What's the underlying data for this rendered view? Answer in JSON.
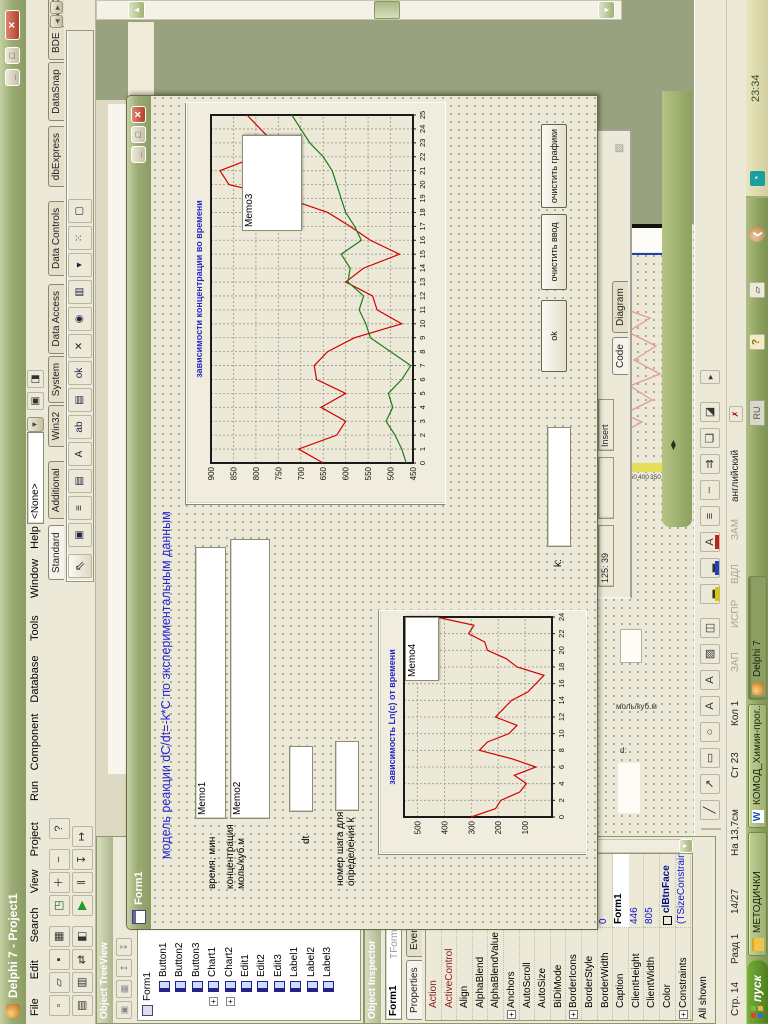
{
  "ide": {
    "title": "Delphi 7 - Project1",
    "menu": [
      "File",
      "Edit",
      "Search",
      "View",
      "Project",
      "Run",
      "Component",
      "Database",
      "Tools",
      "Window",
      "Help"
    ],
    "desktop_combo": "<None>",
    "toolbar_row1": [
      {
        "n": "new-icon",
        "g": "▫"
      },
      {
        "n": "open-icon",
        "g": "▱"
      },
      {
        "n": "save-icon",
        "g": "▪"
      },
      {
        "n": "save-all-icon",
        "g": "▦"
      },
      {
        "n": "open-project-icon",
        "g": "◳"
      },
      {
        "n": "add-file-icon",
        "g": "＋"
      },
      {
        "n": "remove-file-icon",
        "g": "−"
      },
      {
        "n": "help-icon",
        "g": "?"
      }
    ],
    "toolbar_row2": [
      {
        "n": "view-unit-icon",
        "g": "▤"
      },
      {
        "n": "view-form-icon",
        "g": "▥"
      },
      {
        "n": "toggle-form-icon",
        "g": "⇄"
      },
      {
        "n": "new-form-icon",
        "g": "◧"
      },
      {
        "n": "run-icon",
        "g": "▶"
      },
      {
        "n": "pause-icon",
        "g": "‖"
      },
      {
        "n": "trace-into-icon",
        "g": "↧"
      },
      {
        "n": "step-over-icon",
        "g": "↦"
      }
    ],
    "palette_tabs": [
      "Standard",
      "Additional",
      "Win32",
      "System",
      "Data Access",
      "Data Controls",
      "dbExpress",
      "DataSnap",
      "BDE",
      "ADO",
      "InterBase",
      "WebServices",
      "InternetExpress"
    ],
    "palette_active": "Standard",
    "palette_icons": [
      {
        "n": "frames-icon",
        "g": "▣"
      },
      {
        "n": "main-menu-icon",
        "g": "≡"
      },
      {
        "n": "popup-menu-icon",
        "g": "▤"
      },
      {
        "n": "label-icon",
        "g": "A"
      },
      {
        "n": "edit-icon",
        "g": "ab"
      },
      {
        "n": "memo-icon",
        "g": "▤"
      },
      {
        "n": "button-icon",
        "g": "ok"
      },
      {
        "n": "checkbox-icon",
        "g": "✕"
      },
      {
        "n": "radiobutton-icon",
        "g": "◉"
      },
      {
        "n": "listbox-icon",
        "g": "▥"
      },
      {
        "n": "combobox-icon",
        "g": "▾"
      },
      {
        "n": "scrollbar-icon",
        "g": "⁙"
      },
      {
        "n": "groupbox-icon",
        "g": "▢"
      }
    ]
  },
  "treeview": {
    "title": "Object TreeView",
    "root": "Form1",
    "items": [
      "Button1",
      "Button2",
      "Button3",
      "Chart1",
      "Chart2",
      "Edit1",
      "Edit2",
      "Edit3",
      "Label1",
      "Label2",
      "Label3"
    ],
    "expandable": [
      "Chart1",
      "Chart2"
    ]
  },
  "inspector": {
    "title": "Object Inspector",
    "object_name": "Form1",
    "object_type": "TForm1",
    "tabs": [
      "Properties",
      "Events"
    ],
    "props": [
      {
        "n": "Action",
        "v": "",
        "red": true
      },
      {
        "n": "ActiveControl",
        "v": "",
        "red": true
      },
      {
        "n": "Align",
        "v": "alNone"
      },
      {
        "n": "AlphaBlend",
        "v": "False"
      },
      {
        "n": "AlphaBlendValue",
        "v": "255"
      },
      {
        "n": "Anchors",
        "v": "[akLeft,akTop]",
        "exp": true
      },
      {
        "n": "AutoScroll",
        "v": "True"
      },
      {
        "n": "AutoSize",
        "v": "False"
      },
      {
        "n": "BiDiMode",
        "v": "bdLeftToRight"
      },
      {
        "n": "BorderIcons",
        "v": "[biSystemMenu,",
        "exp": true
      },
      {
        "n": "BorderStyle",
        "v": "bsSizeable"
      },
      {
        "n": "BorderWidth",
        "v": "0"
      },
      {
        "n": "Caption",
        "v": "Form1",
        "edit": true
      },
      {
        "n": "ClientHeight",
        "v": "446"
      },
      {
        "n": "ClientWidth",
        "v": "805"
      },
      {
        "n": "Color",
        "v": "clBtnFace",
        "swatch": true
      },
      {
        "n": "Constraints",
        "v": "(TSizeConstraints)",
        "exp": true
      }
    ],
    "status": "All shown"
  },
  "form": {
    "title": "Form1",
    "heading": "модель реакции dC/dt=-k*C по экспериментальным данным",
    "label_time": "время, мин",
    "label_conc1": "концентрация",
    "label_conc2": "моль/куб.м",
    "label_dt": "dt",
    "label_step1": "номер шага для",
    "label_step2": "определения k",
    "label_k": "k:",
    "memo1": "Memo1",
    "memo2": "Memo2",
    "memo3": "Memo3",
    "memo4": "Memo4",
    "buttons": [
      "ok",
      "очистить ввод",
      "очистить графики"
    ]
  },
  "chart_data": [
    {
      "type": "line",
      "title": "зависимости концентрации во времени",
      "x_ticks": [
        0,
        1,
        2,
        3,
        4,
        5,
        6,
        7,
        8,
        9,
        10,
        11,
        12,
        13,
        14,
        15,
        16,
        17,
        18,
        19,
        20,
        21,
        22,
        23,
        24,
        25
      ],
      "ylim": [
        450,
        900
      ],
      "y_ticks": [
        450,
        500,
        550,
        600,
        650,
        700,
        750,
        800,
        850,
        900
      ],
      "grid": true,
      "series": [
        {
          "name": "red",
          "color": "#D40000",
          "values": [
            650,
            705,
            620,
            600,
            655,
            600,
            665,
            670,
            640,
            580,
            475,
            530,
            540,
            600,
            560,
            480,
            545,
            590,
            640,
            730,
            860,
            880,
            800,
            760,
            790,
            820
          ]
        },
        {
          "name": "green",
          "color": "#1B7E1B",
          "values": [
            465,
            475,
            490,
            510,
            495,
            505,
            475,
            455,
            500,
            545,
            555,
            570,
            560,
            595,
            590,
            610,
            565,
            580,
            600,
            610,
            620,
            630,
            650,
            680,
            700,
            720
          ]
        }
      ]
    },
    {
      "type": "line",
      "title": "зависимость Ln(c) от времени",
      "x_ticks": [
        0,
        2,
        4,
        6,
        8,
        10,
        12,
        14,
        16,
        18,
        20,
        22,
        24
      ],
      "ylim": [
        0,
        550
      ],
      "y_ticks": [
        100,
        200,
        300,
        400,
        500
      ],
      "grid": true,
      "series": [
        {
          "name": "red",
          "color": "#D40000",
          "values": [
            300,
            210,
            190,
            120,
            95,
            140,
            60,
            150,
            270,
            240,
            160,
            130,
            210,
            180,
            150,
            90,
            60,
            30,
            130,
            170,
            240,
            250,
            310,
            290,
            430
          ]
        }
      ]
    }
  ],
  "editor": {
    "line_col": "125: 39",
    "mode": "Insert",
    "tabs": [
      "Code",
      "Diagram"
    ]
  },
  "word": {
    "status_cells": [
      "Стр. 14",
      "Разд 1",
      "14/27",
      "На 13,7см",
      "Ст 23",
      "Кол 1"
    ],
    "indicators": [
      "ЗАП",
      "ИСПР",
      "ВДЛ",
      "ЗАМ"
    ],
    "language": "английский",
    "fragment_axis": [
      "500",
      "450",
      "400",
      "350",
      "300"
    ],
    "fragment_label1": "моль/куб.м",
    "fragment_label2": "d:",
    "drawing_icons": [
      {
        "n": "line-icon",
        "g": "╱"
      },
      {
        "n": "arrow-icon",
        "g": "↗"
      },
      {
        "n": "rectangle-icon",
        "g": "▭"
      },
      {
        "n": "oval-icon",
        "g": "○"
      },
      {
        "n": "textbox-icon",
        "g": "A"
      },
      {
        "n": "wordart-icon",
        "g": "А"
      },
      {
        "n": "picture-icon",
        "g": "▨"
      },
      {
        "n": "clipart-icon",
        "g": "◫"
      },
      {
        "n": "fill-color-icon",
        "g": "▂",
        "c": "#D8C800"
      },
      {
        "n": "line-color-icon",
        "g": "▂",
        "c": "#2040C0"
      },
      {
        "n": "font-color-icon",
        "g": "A",
        "c": "#C02020"
      },
      {
        "n": "line-style-icon",
        "g": "≡"
      },
      {
        "n": "dash-style-icon",
        "g": "┄"
      },
      {
        "n": "arrow-style-icon",
        "g": "⇉"
      },
      {
        "n": "shadow-icon",
        "g": "❏"
      },
      {
        "n": "threed-icon",
        "g": "◪"
      }
    ]
  },
  "taskbar": {
    "start": "пуск",
    "buttons": [
      "МЕТОДИЧКИ",
      "КОМОД_Химия-прог...",
      "Delphi 7"
    ],
    "pressed": "Delphi 7",
    "tray_lang": "RU",
    "clock": "23:34"
  }
}
